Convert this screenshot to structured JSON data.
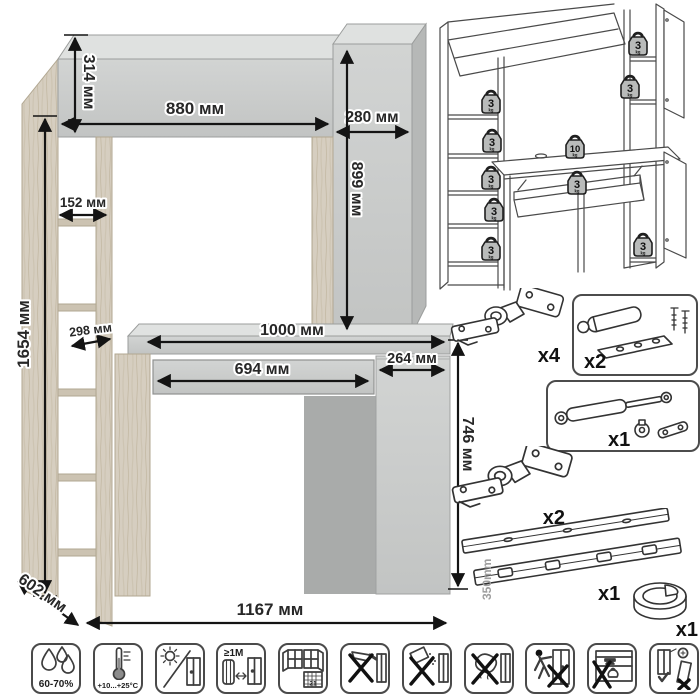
{
  "dimension_drawing": {
    "labels": {
      "overall_height": "1654 мм",
      "hutch_height": "314 мм",
      "hutch_width": "880 мм",
      "side_cabinet_width": "280 мм",
      "side_cabinet_height": "899 мм",
      "shelf_width": "152 мм",
      "shelf_depth": "298 мм",
      "desktop_width": "1000 мм",
      "drawer_width": "694 мм",
      "door_width": "264 мм",
      "desk_height": "746 мм",
      "depth": "602 мм",
      "overall_width": "1167 мм"
    }
  },
  "load_diagram": {
    "weights": [
      {
        "value": "3",
        "unit": "kg",
        "location": "hutch-top-right",
        "x": 210,
        "y": 44
      },
      {
        "value": "3",
        "unit": "kg",
        "location": "right-shelf",
        "x": 202,
        "y": 87
      },
      {
        "value": "3",
        "unit": "kg",
        "location": "left-shelf-1",
        "x": 63,
        "y": 102
      },
      {
        "value": "3",
        "unit": "kg",
        "location": "left-shelf-2",
        "x": 64,
        "y": 141
      },
      {
        "value": "3",
        "unit": "kg",
        "location": "left-shelf-3",
        "x": 63,
        "y": 178
      },
      {
        "value": "3",
        "unit": "kg",
        "location": "left-shelf-4",
        "x": 66,
        "y": 210
      },
      {
        "value": "3",
        "unit": "kg",
        "location": "left-shelf-5",
        "x": 63,
        "y": 249
      },
      {
        "value": "10",
        "unit": "kg",
        "location": "desktop",
        "x": 147,
        "y": 147
      },
      {
        "value": "3",
        "unit": "kg",
        "location": "drawer",
        "x": 149,
        "y": 183
      },
      {
        "value": "3",
        "unit": "kg",
        "location": "base-cabinet",
        "x": 215,
        "y": 245
      }
    ]
  },
  "hardware": {
    "items": [
      {
        "id": "hinge-top",
        "count": "x4"
      },
      {
        "id": "soft-close-damper",
        "count": "x2"
      },
      {
        "id": "gas-lift",
        "count": "x1"
      },
      {
        "id": "hinge-bottom",
        "count": "x2"
      },
      {
        "id": "drawer-slides",
        "count": "x1",
        "length": "350mm"
      },
      {
        "id": "cable-grommet",
        "count": "x1"
      }
    ]
  },
  "care_icons": [
    {
      "id": "humidity",
      "label": "60-70%"
    },
    {
      "id": "temperature",
      "label": "+10...+25°C"
    },
    {
      "id": "no-direct-sunlight",
      "label": ""
    },
    {
      "id": "heat-distance",
      "label": "≥1M"
    },
    {
      "id": "acclimatization",
      "label": "21"
    },
    {
      "id": "no-sharp-objects",
      "label": ""
    },
    {
      "id": "no-abrasive-cleaners",
      "label": ""
    },
    {
      "id": "no-wet-cleaning",
      "label": ""
    },
    {
      "id": "no-dragging",
      "label": ""
    },
    {
      "id": "no-heavy-items",
      "label": ""
    },
    {
      "id": "wall-anchoring",
      "label": ""
    }
  ]
}
